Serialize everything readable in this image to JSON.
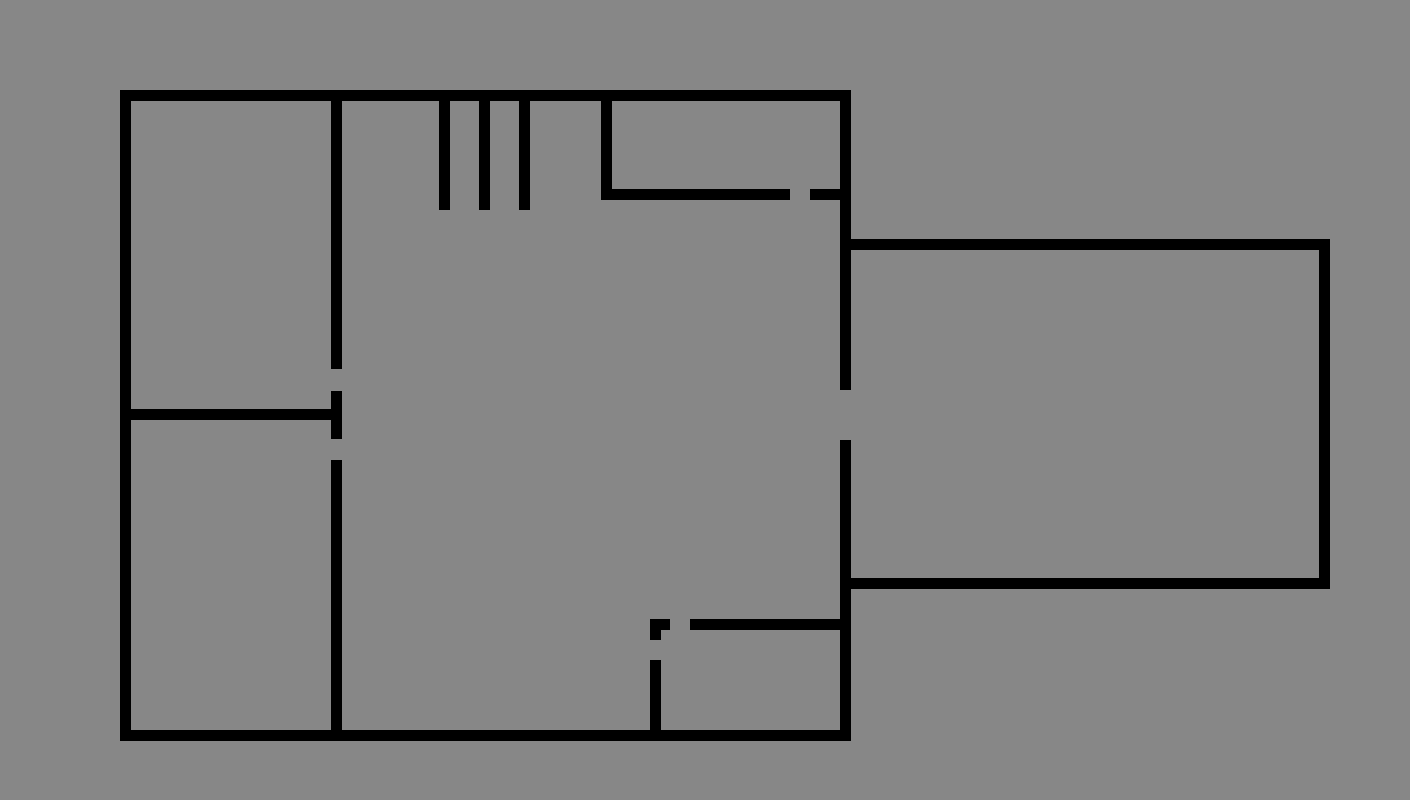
{
  "floor_plan": {
    "canvas": {
      "width": 1410,
      "height": 800
    },
    "background_color": "#878787",
    "wall_color": "#000000",
    "wall_thickness": 11,
    "walls": [
      {
        "name": "outer-top-wall",
        "x": 120,
        "y": 90,
        "w": 731,
        "h": 11
      },
      {
        "name": "outer-left-wall",
        "x": 120,
        "y": 90,
        "w": 11,
        "h": 651
      },
      {
        "name": "outer-bottom-wall",
        "x": 120,
        "y": 730,
        "w": 731,
        "h": 11
      },
      {
        "name": "outer-right-wall-upper",
        "x": 840,
        "y": 90,
        "w": 11,
        "h": 300
      },
      {
        "name": "outer-right-wall-lower",
        "x": 840,
        "y": 440,
        "w": 11,
        "h": 301
      },
      {
        "name": "interior-vertical-wall-upper",
        "x": 331,
        "y": 90,
        "w": 11,
        "h": 279
      },
      {
        "name": "interior-vertical-wall-mid",
        "x": 331,
        "y": 391,
        "w": 11,
        "h": 48
      },
      {
        "name": "interior-vertical-wall-lower",
        "x": 331,
        "y": 460,
        "w": 11,
        "h": 281
      },
      {
        "name": "left-rooms-divider-wall",
        "x": 120,
        "y": 409,
        "w": 222,
        "h": 11
      },
      {
        "name": "top-right-room-left-wall",
        "x": 601,
        "y": 90,
        "w": 11,
        "h": 110
      },
      {
        "name": "top-right-room-bottom-wall",
        "x": 601,
        "y": 189,
        "w": 189,
        "h": 11
      },
      {
        "name": "top-right-room-bottom-stub",
        "x": 810,
        "y": 189,
        "w": 41,
        "h": 11
      },
      {
        "name": "stair-tick-1",
        "x": 439,
        "y": 90,
        "w": 11,
        "h": 120
      },
      {
        "name": "stair-tick-2",
        "x": 479,
        "y": 90,
        "w": 11,
        "h": 120
      },
      {
        "name": "stair-tick-3",
        "x": 519,
        "y": 90,
        "w": 11,
        "h": 120
      },
      {
        "name": "small-room-top-wall",
        "x": 690,
        "y": 619,
        "w": 161,
        "h": 11
      },
      {
        "name": "small-room-top-stub",
        "x": 650,
        "y": 619,
        "w": 20,
        "h": 11
      },
      {
        "name": "small-room-corner-stub",
        "x": 650,
        "y": 619,
        "w": 11,
        "h": 21
      },
      {
        "name": "small-room-left-wall",
        "x": 650,
        "y": 660,
        "w": 11,
        "h": 81
      },
      {
        "name": "extension-room-top-wall",
        "x": 851,
        "y": 239,
        "w": 479,
        "h": 11
      },
      {
        "name": "extension-room-right-wall",
        "x": 1319,
        "y": 239,
        "w": 11,
        "h": 350
      },
      {
        "name": "extension-room-bottom-wall",
        "x": 851,
        "y": 578,
        "w": 479,
        "h": 11
      }
    ],
    "door_gaps": [
      {
        "name": "gap-interior-wall-upper",
        "x": 331,
        "y": 369,
        "w": 11,
        "h": 22
      },
      {
        "name": "gap-interior-wall-lower",
        "x": 331,
        "y": 439,
        "w": 11,
        "h": 21
      },
      {
        "name": "gap-right-wall",
        "x": 840,
        "y": 390,
        "w": 11,
        "h": 50
      },
      {
        "name": "gap-top-right-room",
        "x": 790,
        "y": 189,
        "w": 20,
        "h": 11
      },
      {
        "name": "gap-small-room-top",
        "x": 670,
        "y": 619,
        "w": 20,
        "h": 11
      },
      {
        "name": "gap-small-room-left",
        "x": 650,
        "y": 640,
        "w": 11,
        "h": 20
      }
    ]
  }
}
